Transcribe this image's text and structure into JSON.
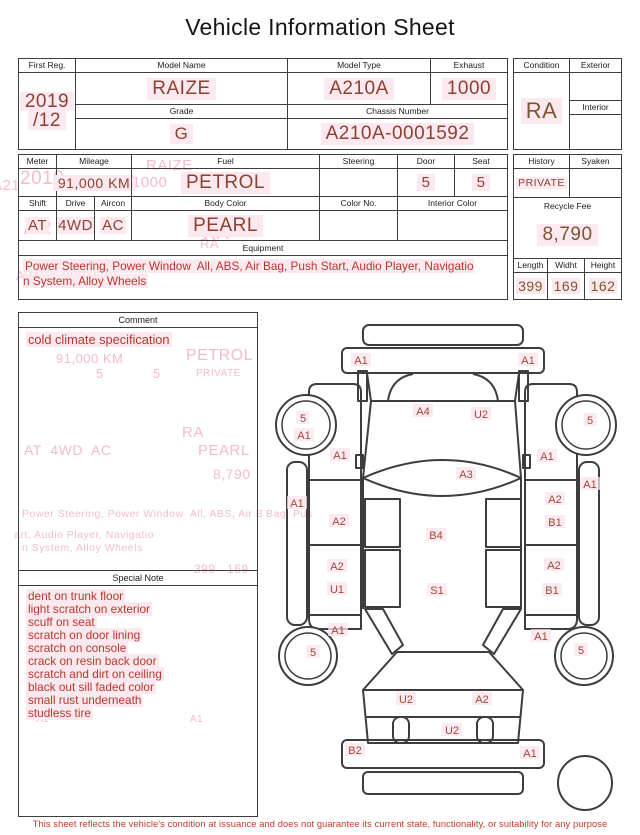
{
  "title": "Vehicle Information Sheet",
  "colors": {
    "value_red": "#8d4130",
    "value_brown": "#7e5530",
    "note_red": "#b8372b",
    "highlight_pink": "#fce9f0",
    "ghost_pink": "#f3aec8",
    "line": "#3d3d3d",
    "disclaimer_red": "#c5372b"
  },
  "s1": {
    "first_reg_label": "First Reg.",
    "first_reg_value_1": "2019",
    "first_reg_value_2": "/12",
    "model_name_label": "Model Name",
    "model_name_value": "RAIZE",
    "model_type_label": "Model Type",
    "model_type_value": "A210A",
    "exhaust_label": "Exhaust",
    "exhaust_value": "1000",
    "grade_label": "Grade",
    "grade_value": "G",
    "chassis_label": "Chassis Number",
    "chassis_value": "A210A-0001592",
    "condition_label": "Condition",
    "condition_value": "RA",
    "exterior_label": "Exterior",
    "exterior_value": "",
    "interior_label": "Interior",
    "interior_value": ""
  },
  "s2": {
    "meter_label": "Meter",
    "meter_value": "",
    "mileage_label": "Mileage",
    "mileage_value": "91,000 KM",
    "fuel_label": "Fuel",
    "fuel_value": "PETROL",
    "steering_label": "Steering",
    "steering_value": "",
    "door_label": "Door",
    "door_value": "5",
    "seat_label": "Seat",
    "seat_value": "5",
    "shift_label": "Shift",
    "shift_value": "AT",
    "drive_label": "Drive",
    "drive_value": "4WD",
    "aircon_label": "Aircon",
    "aircon_value": "AC",
    "body_color_label": "Body Color",
    "body_color_value": "PEARL",
    "color_no_label": "Color No.",
    "color_no_value": "",
    "interior_color_label": "Interior Color",
    "interior_color_value": "",
    "equipment_label": "Equipment",
    "equipment_value": "Power Steering, Power Window  All, ABS, Air Bag, Push Start, Audio Player, Navigatio\nn System, Alloy Wheels",
    "history_label": "History",
    "history_value": "PRIVATE",
    "syaken_label": "Syaken",
    "syaken_value": "",
    "recycle_label": "Recycle Fee",
    "recycle_value": "8,790",
    "length_label": "Length",
    "length_value": "399",
    "width_label": "Widht",
    "width_value": "169",
    "height_label": "Height",
    "height_value": "162"
  },
  "comment": {
    "label": "Comment",
    "lines": [
      "cold climate specification"
    ]
  },
  "special_note": {
    "label": "Special Note",
    "lines": [
      "dent on trunk floor",
      "light scratch on exterior",
      "scuff on seat",
      "scratch on door lining",
      "scratch on console",
      "crack on resin back door",
      "scratch and dirt on ceiling",
      "black out sill faded color",
      "small rust underneath",
      "studless tire"
    ]
  },
  "diagram": {
    "labels": [
      {
        "text": "A1",
        "x": 95,
        "y": 48
      },
      {
        "text": "A1",
        "x": 262,
        "y": 48
      },
      {
        "text": "A4",
        "x": 157,
        "y": 99
      },
      {
        "text": "U2",
        "x": 215,
        "y": 102
      },
      {
        "text": "5",
        "x": 37,
        "y": 106
      },
      {
        "text": "A1",
        "x": 38,
        "y": 123
      },
      {
        "text": "5",
        "x": 324,
        "y": 108
      },
      {
        "text": "A1",
        "x": 74,
        "y": 143
      },
      {
        "text": "A1",
        "x": 281,
        "y": 144
      },
      {
        "text": "A3",
        "x": 200,
        "y": 162
      },
      {
        "text": "A1",
        "x": 31,
        "y": 191
      },
      {
        "text": "A1",
        "x": 324,
        "y": 172
      },
      {
        "text": "A2",
        "x": 73,
        "y": 209
      },
      {
        "text": "A2",
        "x": 289,
        "y": 187
      },
      {
        "text": "B1",
        "x": 289,
        "y": 210
      },
      {
        "text": "B4",
        "x": 170,
        "y": 223
      },
      {
        "text": "A2",
        "x": 71,
        "y": 254
      },
      {
        "text": "U1",
        "x": 71,
        "y": 277
      },
      {
        "text": "S1",
        "x": 171,
        "y": 278
      },
      {
        "text": "A2",
        "x": 288,
        "y": 253
      },
      {
        "text": "B1",
        "x": 286,
        "y": 278
      },
      {
        "text": "A1",
        "x": 72,
        "y": 318
      },
      {
        "text": "A1",
        "x": 275,
        "y": 324
      },
      {
        "text": "5",
        "x": 47,
        "y": 340
      },
      {
        "text": "5",
        "x": 315,
        "y": 338
      },
      {
        "text": "U2",
        "x": 140,
        "y": 387
      },
      {
        "text": "A2",
        "x": 216,
        "y": 387
      },
      {
        "text": "U2",
        "x": 186,
        "y": 418
      },
      {
        "text": "B2",
        "x": 89,
        "y": 438
      },
      {
        "text": "A1",
        "x": 264,
        "y": 441
      }
    ]
  },
  "ghosts": [
    {
      "text": "2019",
      "x": 20,
      "y": 168,
      "size": 19
    },
    {
      "text": "/12",
      "x": 24,
      "y": 218,
      "size": 19
    },
    {
      "text": "RAIZE",
      "x": 146,
      "y": 157,
      "size": 15
    },
    {
      "text": "1000",
      "x": 132,
      "y": 174,
      "size": 15
    },
    {
      "text": "RA",
      "x": 203,
      "y": 223,
      "size": 18
    },
    {
      "text": "A21",
      "x": -8,
      "y": 177,
      "size": 15
    },
    {
      "text": "RA",
      "x": 200,
      "y": 236,
      "size": 13
    },
    {
      "text": "G",
      "x": 172,
      "y": 256,
      "size": 14
    },
    {
      "text": "A210A-0001592",
      "x": 16,
      "y": 268,
      "size": 13
    },
    {
      "text": "91,000 KM",
      "x": 56,
      "y": 351,
      "size": 13
    },
    {
      "text": "PETROL",
      "x": 186,
      "y": 347,
      "size": 16
    },
    {
      "text": "5",
      "x": 96,
      "y": 366,
      "size": 13
    },
    {
      "text": "5",
      "x": 153,
      "y": 366,
      "size": 13
    },
    {
      "text": "PRIVATE",
      "x": 196,
      "y": 368,
      "size": 10
    },
    {
      "text": "RA",
      "x": 182,
      "y": 424,
      "size": 15
    },
    {
      "text": "AT  4WD  AC",
      "x": 24,
      "y": 442,
      "size": 14
    },
    {
      "text": "PEARL",
      "x": 198,
      "y": 442,
      "size": 15
    },
    {
      "text": "8,790",
      "x": 213,
      "y": 466,
      "size": 14
    },
    {
      "text": "Power Steering, Power Window  All, ABS, Air B",
      "x": 22,
      "y": 508,
      "size": 10.5
    },
    {
      "text": "Bag, Pus",
      "x": 266,
      "y": 508,
      "size": 10.5
    },
    {
      "text": "art, Audio Player, Navigatio",
      "x": 14,
      "y": 529,
      "size": 10.5
    },
    {
      "text": "n System, Alloy Wheels",
      "x": 22,
      "y": 542,
      "size": 10.5
    },
    {
      "text": "399   169",
      "x": 194,
      "y": 562,
      "size": 12
    },
    {
      "text": "A1",
      "x": 36,
      "y": 714,
      "size": 10
    },
    {
      "text": "A1",
      "x": 190,
      "y": 714,
      "size": 10
    }
  ],
  "disclaimer": "This sheet reflects the vehicle's condition at issuance and does not guarantee its current state, functionality, or suitability for any purpose"
}
